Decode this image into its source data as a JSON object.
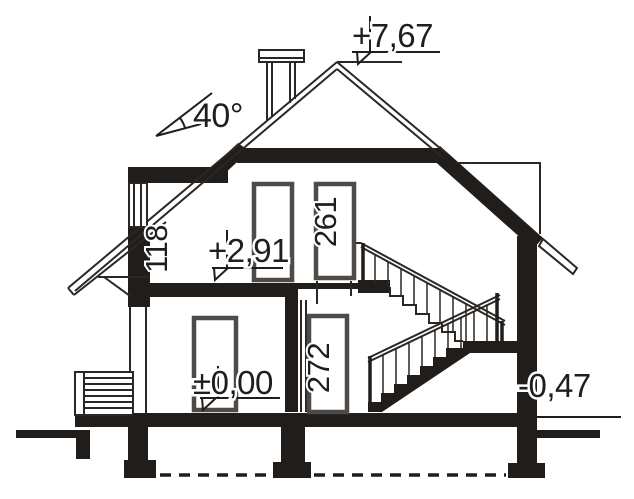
{
  "title": "house-cross-section-drawing",
  "colors": {
    "ink": "#211d1a",
    "frame": "#4e4a47",
    "background": "#ffffff"
  },
  "annotations": {
    "ridge_level": "+7,67",
    "roof_angle": "40°",
    "knee_wall_height": "118",
    "upper_floor_level": "+2,91",
    "upper_room_height": "261",
    "ground_floor_level": "±0,00",
    "ground_room_height": "272",
    "terrain_level": "-0,47"
  }
}
